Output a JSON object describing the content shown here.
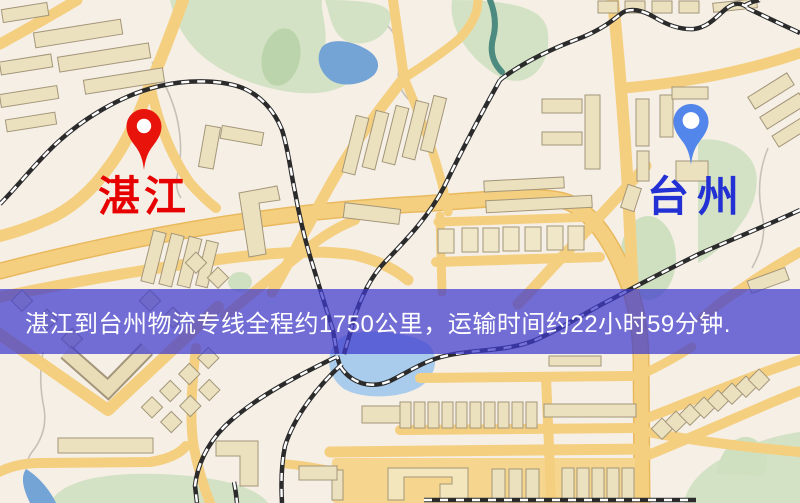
{
  "origin": {
    "name": "湛江",
    "marker_color": "#e8140c",
    "label_color": "#e60000"
  },
  "destination": {
    "name": "台州",
    "marker_color": "#5286ea",
    "label_color": "#2230d4"
  },
  "banner": {
    "text": "湛江到台州物流专线全程约1750公里，运输时间约22小时59分钟.",
    "background": "rgba(62,58,205,0.72)",
    "text_color": "#ffffff"
  },
  "route": {
    "distance_km": "1750",
    "duration": "22小时59分钟"
  },
  "map_colors": {
    "background": "#f6efe6",
    "road": "#f5cf80",
    "road_casing": "#e9b95e",
    "building_fill": "#ece1bf",
    "building_stroke": "#a3967a",
    "park": "#d3e2c4",
    "park_dark": "#bcd4ab",
    "water": "#74a3d6",
    "lake": "#a9cbec",
    "stream": "#4d8a80",
    "railway": "#2b2b2b",
    "contour": "#c5c1b8"
  }
}
